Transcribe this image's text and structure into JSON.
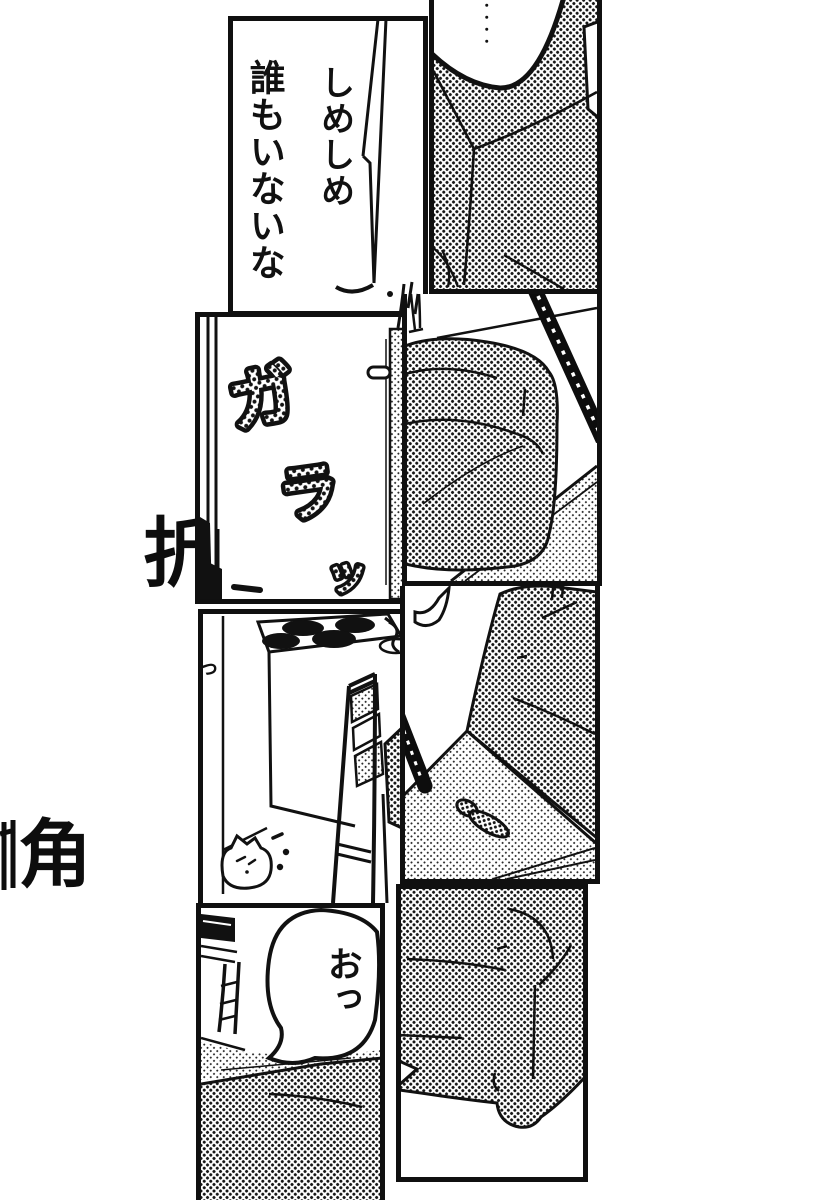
{
  "page": {
    "paper_color": "#ffffff",
    "ink_color": "#111111"
  },
  "margin_text": {
    "kanji_top": "折",
    "kanji_bottom": "角"
  },
  "panel1": {
    "speech_col_right": "しめしめ",
    "speech_col_left": "誰もいないな"
  },
  "panel2": {
    "sfx_silence_dots": "・・・・"
  },
  "panel3": {
    "sfx_door_ga": "ガ",
    "sfx_door_ra": "ラ",
    "sfx_door_tsu": "ッ"
  },
  "panel5": {
    "sfx_small_tsu": "っ"
  },
  "panel8": {
    "speech_bubble": "おっ"
  }
}
